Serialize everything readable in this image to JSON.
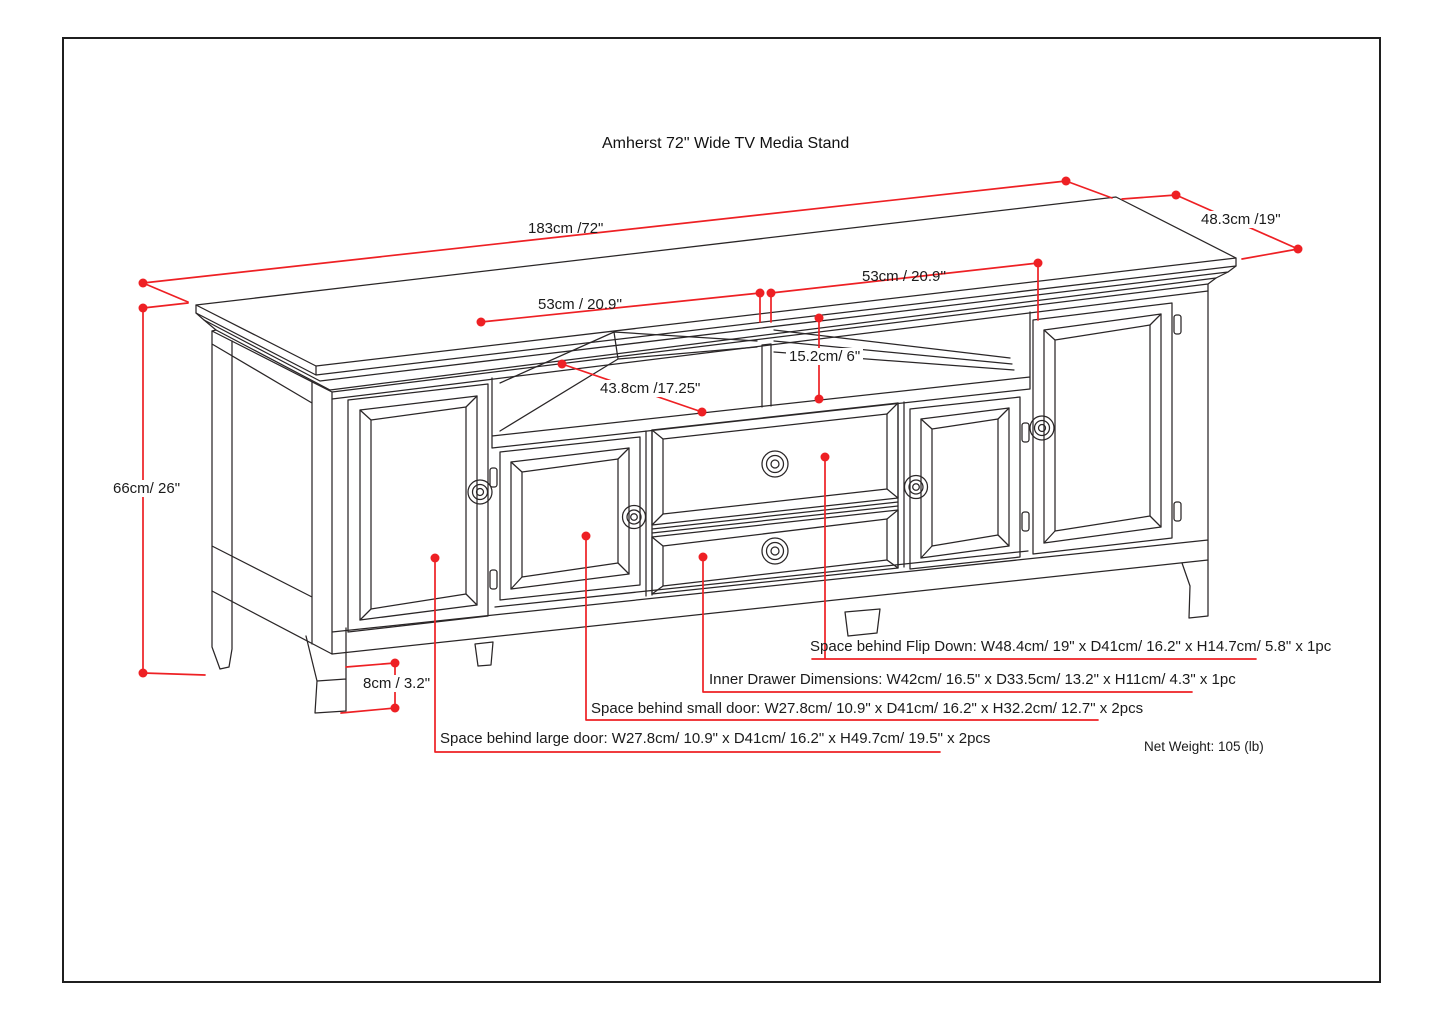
{
  "page": {
    "title": "Amherst 72\" Wide TV Media Stand"
  },
  "colors": {
    "dimension_red": "#ee2024",
    "line_black": "#2a2627"
  },
  "dimensions": {
    "top_width": "183cm /72\"",
    "top_depth": "48.3cm /19\"",
    "shelf_left_width": "53cm / 20.9''",
    "shelf_right_width": "53cm / 20.9''",
    "shelf_opening_height": "15.2cm/ 6\"",
    "shelf_depth": "43.8cm /17.25\"",
    "overall_height": "66cm/ 26\"",
    "leg_height": "8cm / 3.2\""
  },
  "notes": {
    "flip_down": "Space behind Flip Down: W48.4cm/ 19\" x D41cm/ 16.2\" x H14.7cm/ 5.8\" x 1pc",
    "inner_drawer": "Inner Drawer Dimensions: W42cm/ 16.5\" x D33.5cm/ 13.2\" x H11cm/ 4.3\" x 1pc",
    "small_door": "Space behind small door: W27.8cm/ 10.9\" x D41cm/ 16.2\" x H32.2cm/ 12.7\" x 2pcs",
    "large_door": "Space behind large door: W27.8cm/ 10.9\" x D41cm/ 16.2\" x H49.7cm/ 19.5\" x 2pcs",
    "net_weight": "Net Weight: 105 (lb)"
  }
}
